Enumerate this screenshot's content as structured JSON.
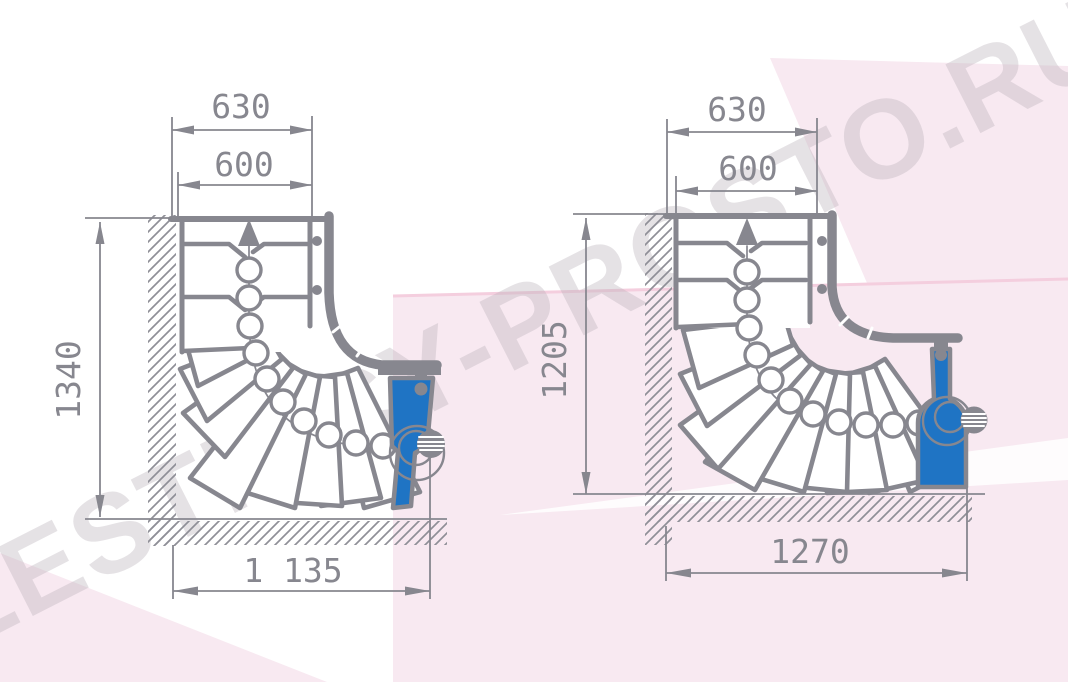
{
  "watermark": {
    "text": "LESTNICY-PROSTO.RU"
  },
  "colors": {
    "line_gray": "#87878f",
    "post_blue": "#1f74c4",
    "background_pink": "#f8e9f1",
    "accent_pink": "#f4cede"
  },
  "diagrams": [
    {
      "id": "left-staircase",
      "dim_top_outer": "630",
      "dim_top_inner": "600",
      "dim_side": "1340",
      "dim_bottom": "1 135"
    },
    {
      "id": "right-staircase",
      "dim_top_outer": "630",
      "dim_top_inner": "600",
      "dim_side": "1205",
      "dim_bottom": "1270"
    }
  ]
}
